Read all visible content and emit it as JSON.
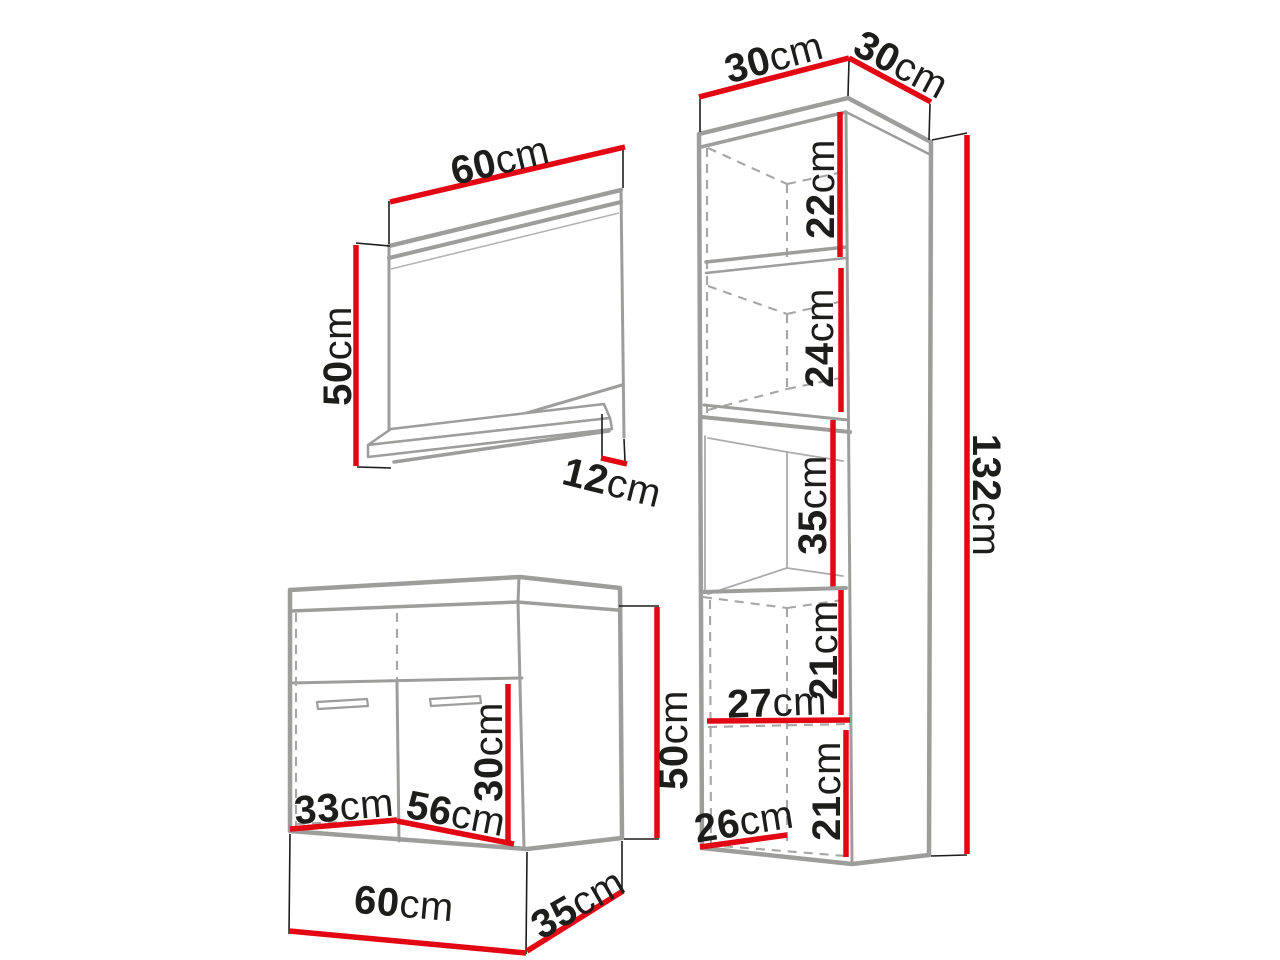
{
  "title": "Bathroom furniture set dimension diagram",
  "colors": {
    "dimension_red": "#e30613",
    "outline_gray": "#9d9d9c",
    "text_black": "#1d1d1b",
    "background": "#ffffff"
  },
  "mirror": {
    "width": {
      "value": "60",
      "unit": "cm"
    },
    "height": {
      "value": "50",
      "unit": "cm"
    },
    "shelf_depth": {
      "value": "12",
      "unit": "cm"
    }
  },
  "vanity": {
    "door_inner_width": {
      "value": "33",
      "unit": "cm"
    },
    "inner_width": {
      "value": "56",
      "unit": "cm"
    },
    "inner_height": {
      "value": "30",
      "unit": "cm"
    },
    "height": {
      "value": "50",
      "unit": "cm"
    },
    "width": {
      "value": "60",
      "unit": "cm"
    },
    "depth": {
      "value": "35",
      "unit": "cm"
    }
  },
  "tall_cabinet": {
    "top_width": {
      "value": "30",
      "unit": "cm"
    },
    "top_depth": {
      "value": "30",
      "unit": "cm"
    },
    "upper_compartment_height": {
      "value": "22",
      "unit": "cm"
    },
    "middle_compartment_height": {
      "value": "24",
      "unit": "cm"
    },
    "niche_height": {
      "value": "35",
      "unit": "cm"
    },
    "lower_compartment1_height": {
      "value": "21",
      "unit": "cm"
    },
    "inner_width": {
      "value": "27",
      "unit": "cm"
    },
    "lower_compartment2_height": {
      "value": "21",
      "unit": "cm"
    },
    "bottom_inner_width": {
      "value": "26",
      "unit": "cm"
    },
    "total_height": {
      "value": "132",
      "unit": "cm"
    }
  }
}
